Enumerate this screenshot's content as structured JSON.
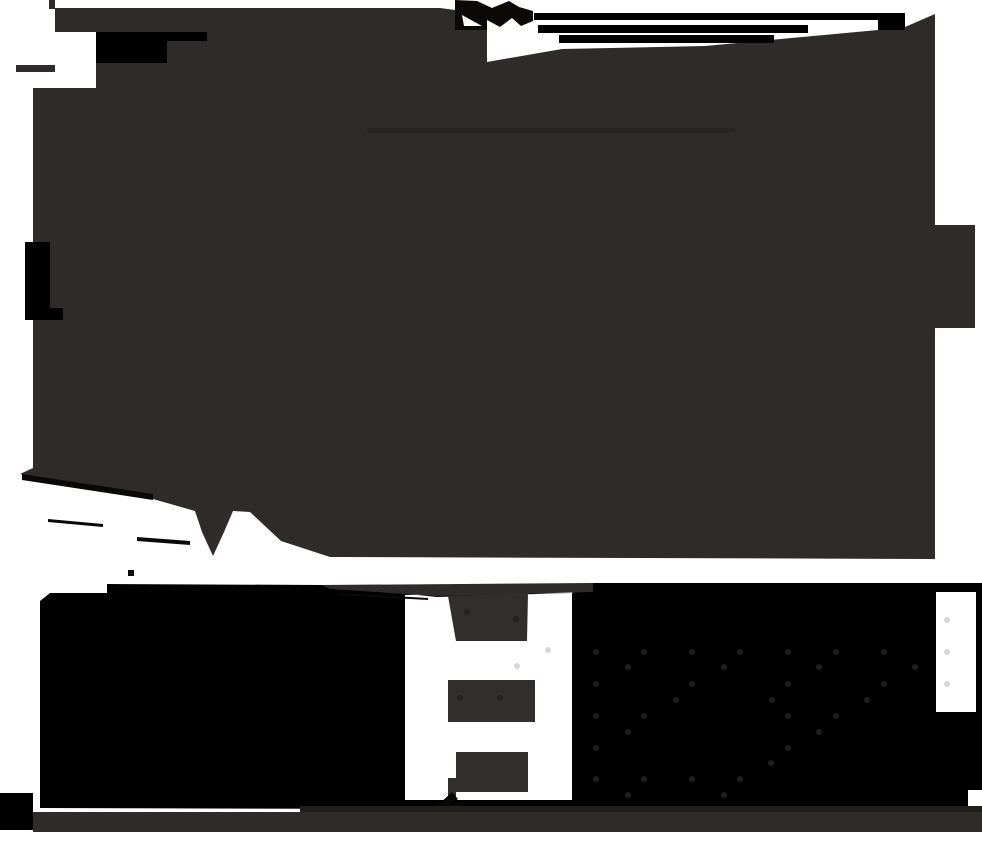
{
  "canvas": {
    "width": 982,
    "height": 844,
    "background": "#FFFFFF"
  },
  "palette": {
    "dark": "#2F2B2B",
    "black": "#000000",
    "white": "#FFFFFF",
    "near_black": "#0B0808",
    "darker_strip": "#221E1E",
    "faint_line": "#282425",
    "dash": "#322E2D",
    "dot_on_black": "#221D1D",
    "dot_on_white": "#D9D5D3",
    "dot_on_dash": "#272221"
  },
  "shapes": [
    {
      "name": "top-mass",
      "type": "path",
      "fill": "dark",
      "d": "M55,8 H440 L455,10 V30 H487 V62 L562,49 L705,46 L878,30 L905,27 L935,14 V225 H975 V328 H935 V559 L330,557 L281,541 L250,512 L233,511 L224,532 L213,556 L202,532 L195,511 L153,499 L20,474 L33,468 V320 H25 V242 H33 V88 H96 V32 H55 Z"
    },
    {
      "name": "top-left-spike-vertical",
      "type": "rect",
      "fill": "dark",
      "x": 49,
      "y": 0,
      "w": 6,
      "h": 9
    },
    {
      "name": "left-spike-horizontal",
      "type": "rect",
      "fill": "dark",
      "x": 16,
      "y": 65,
      "w": 39,
      "h": 7
    },
    {
      "name": "top-left-black-rect",
      "type": "rect",
      "fill": "black",
      "x": 96,
      "y": 32,
      "w": 71,
      "h": 31
    },
    {
      "name": "top-left-black-ext",
      "type": "rect",
      "fill": "black",
      "x": 167,
      "y": 32,
      "w": 40,
      "h": 9
    },
    {
      "name": "left-edge-black-rect",
      "type": "rect",
      "fill": "black",
      "x": 25,
      "y": 242,
      "w": 25,
      "h": 66
    },
    {
      "name": "left-edge-black-rect-2",
      "type": "rect",
      "fill": "black",
      "x": 25,
      "y": 308,
      "w": 38,
      "h": 12
    },
    {
      "name": "top-splash-blob",
      "type": "path",
      "fill": "near_black",
      "d": "M455,0 V30 H487 L487,20 L500,27 L512,18 L521,26 L533,21 L533,11 L519,7 L509,1 L492,8 L477,1 Z"
    },
    {
      "name": "splash-white-notch",
      "type": "path",
      "fill": "white",
      "d": "M462,15 L482,26 L464,26 Z"
    },
    {
      "name": "top-bar-1",
      "type": "rect",
      "fill": "black",
      "x": 534,
      "y": 13,
      "w": 371,
      "h": 7
    },
    {
      "name": "top-bar-1b",
      "type": "rect",
      "fill": "black",
      "x": 878,
      "y": 20,
      "w": 27,
      "h": 10
    },
    {
      "name": "top-bar-2",
      "type": "rect",
      "fill": "black",
      "x": 538,
      "y": 25,
      "w": 270,
      "h": 8
    },
    {
      "name": "top-bar-3",
      "type": "rect",
      "fill": "black",
      "x": 559,
      "y": 35,
      "w": 215,
      "h": 8
    },
    {
      "name": "faint-interior-line",
      "type": "rect",
      "fill": "faint_line",
      "x": 367,
      "y": 128,
      "w": 368,
      "h": 5
    },
    {
      "name": "bottom-edge-streak",
      "type": "path",
      "fill": "near_black",
      "d": "M22,474 L153,494 L153,500 L22,480 Z"
    },
    {
      "name": "band-streak-a",
      "type": "path",
      "fill": "near_black",
      "d": "M48,519 L103,524 L103,527 L48,522 Z"
    },
    {
      "name": "band-streak-b",
      "type": "path",
      "fill": "near_black",
      "d": "M137,537 L190,541 L190,545 L137,541 Z"
    },
    {
      "name": "band-speck",
      "type": "rect",
      "fill": "near_black",
      "x": 128,
      "y": 570,
      "w": 6,
      "h": 6
    },
    {
      "name": "arrow-blob-peak",
      "type": "path",
      "fill": "dark",
      "d": "M203,510 L209,493 L216,510 Z"
    },
    {
      "name": "bottom-mass",
      "type": "path",
      "fill": "black",
      "fillRule": "evenodd",
      "d": "M40,601 L50,593 L107,593 L107,584 L322,585 L437,597 L572,593 L593,583 L982,583 L982,790 L968,790 L968,807 L417,809 L40,808 Z M405,595 L572,593 L572,800 L405,800 Z M936,592 H976 V712 H936 Z"
    },
    {
      "name": "bottom-top-taper-strip",
      "type": "path",
      "fill": "dark",
      "d": "M322,585 L593,583 L593,592 L437,596 L330,589 Z"
    },
    {
      "name": "bottom-taper-line-2",
      "type": "path",
      "fill": "near_black",
      "d": "M338,593 L428,598 L428,600 L338,595 Z"
    },
    {
      "name": "dashed-arrow-dash-1",
      "type": "path",
      "fill": "dash",
      "d": "M448,596 L528,593 L527,641 L456,641 Z"
    },
    {
      "name": "dashed-arrow-dash-2",
      "type": "rect",
      "fill": "dash",
      "x": 448,
      "y": 680,
      "w": 87,
      "h": 42
    },
    {
      "name": "dashed-arrow-dash-3",
      "type": "rect",
      "fill": "dash",
      "x": 456,
      "y": 752,
      "w": 72,
      "h": 40
    },
    {
      "name": "dash-3-tail",
      "type": "path",
      "fill": "dash",
      "d": "M448,778 L456,778 L456,800 L448,800 Z"
    },
    {
      "name": "arrowhead",
      "type": "path",
      "fill": "near_black",
      "d": "M437,806 L452,792 L458,799 L449,805 L463,801 L464,805 L443,810 Z"
    },
    {
      "name": "bottom-left-corner-black",
      "type": "rect",
      "fill": "black",
      "x": 0,
      "y": 793,
      "w": 33,
      "h": 37
    },
    {
      "name": "footer-dark-strip",
      "type": "rect",
      "fill": "darker_strip",
      "x": 300,
      "y": 806,
      "w": 682,
      "h": 7
    },
    {
      "name": "footer-gray-strip",
      "type": "rect",
      "fill": "dark",
      "x": 33,
      "y": 812,
      "w": 949,
      "h": 20
    }
  ],
  "dots": [
    {
      "name": "dot-lattice-on-black",
      "fill": "dot_on_black",
      "r": 3,
      "points": [
        [
          596,
          652
        ],
        [
          644,
          652
        ],
        [
          692,
          652
        ],
        [
          740,
          652
        ],
        [
          788,
          652
        ],
        [
          836,
          652
        ],
        [
          884,
          652
        ],
        [
          628,
          667
        ],
        [
          724,
          667
        ],
        [
          819,
          667
        ],
        [
          915,
          667
        ],
        [
          596,
          684
        ],
        [
          692,
          684
        ],
        [
          788,
          684
        ],
        [
          884,
          684
        ],
        [
          676,
          700
        ],
        [
          772,
          700
        ],
        [
          867,
          700
        ],
        [
          596,
          716
        ],
        [
          644,
          716
        ],
        [
          788,
          716
        ],
        [
          836,
          716
        ],
        [
          628,
          732
        ],
        [
          819,
          732
        ],
        [
          596,
          748
        ],
        [
          788,
          748
        ],
        [
          771,
          763
        ],
        [
          596,
          779
        ],
        [
          644,
          779
        ],
        [
          692,
          779
        ],
        [
          740,
          779
        ],
        [
          628,
          795
        ],
        [
          724,
          795
        ]
      ]
    },
    {
      "name": "dot-lattice-on-white",
      "fill": "dot_on_white",
      "r": 3,
      "points": [
        [
          947,
          620
        ],
        [
          947,
          652
        ],
        [
          947,
          684
        ],
        [
          548,
          650
        ],
        [
          517,
          666
        ]
      ]
    },
    {
      "name": "dot-lattice-on-dash",
      "fill": "dot_on_dash",
      "r": 3,
      "points": [
        [
          467,
          612
        ],
        [
          516,
          619
        ],
        [
          460,
          698
        ],
        [
          500,
          698
        ]
      ]
    }
  ]
}
